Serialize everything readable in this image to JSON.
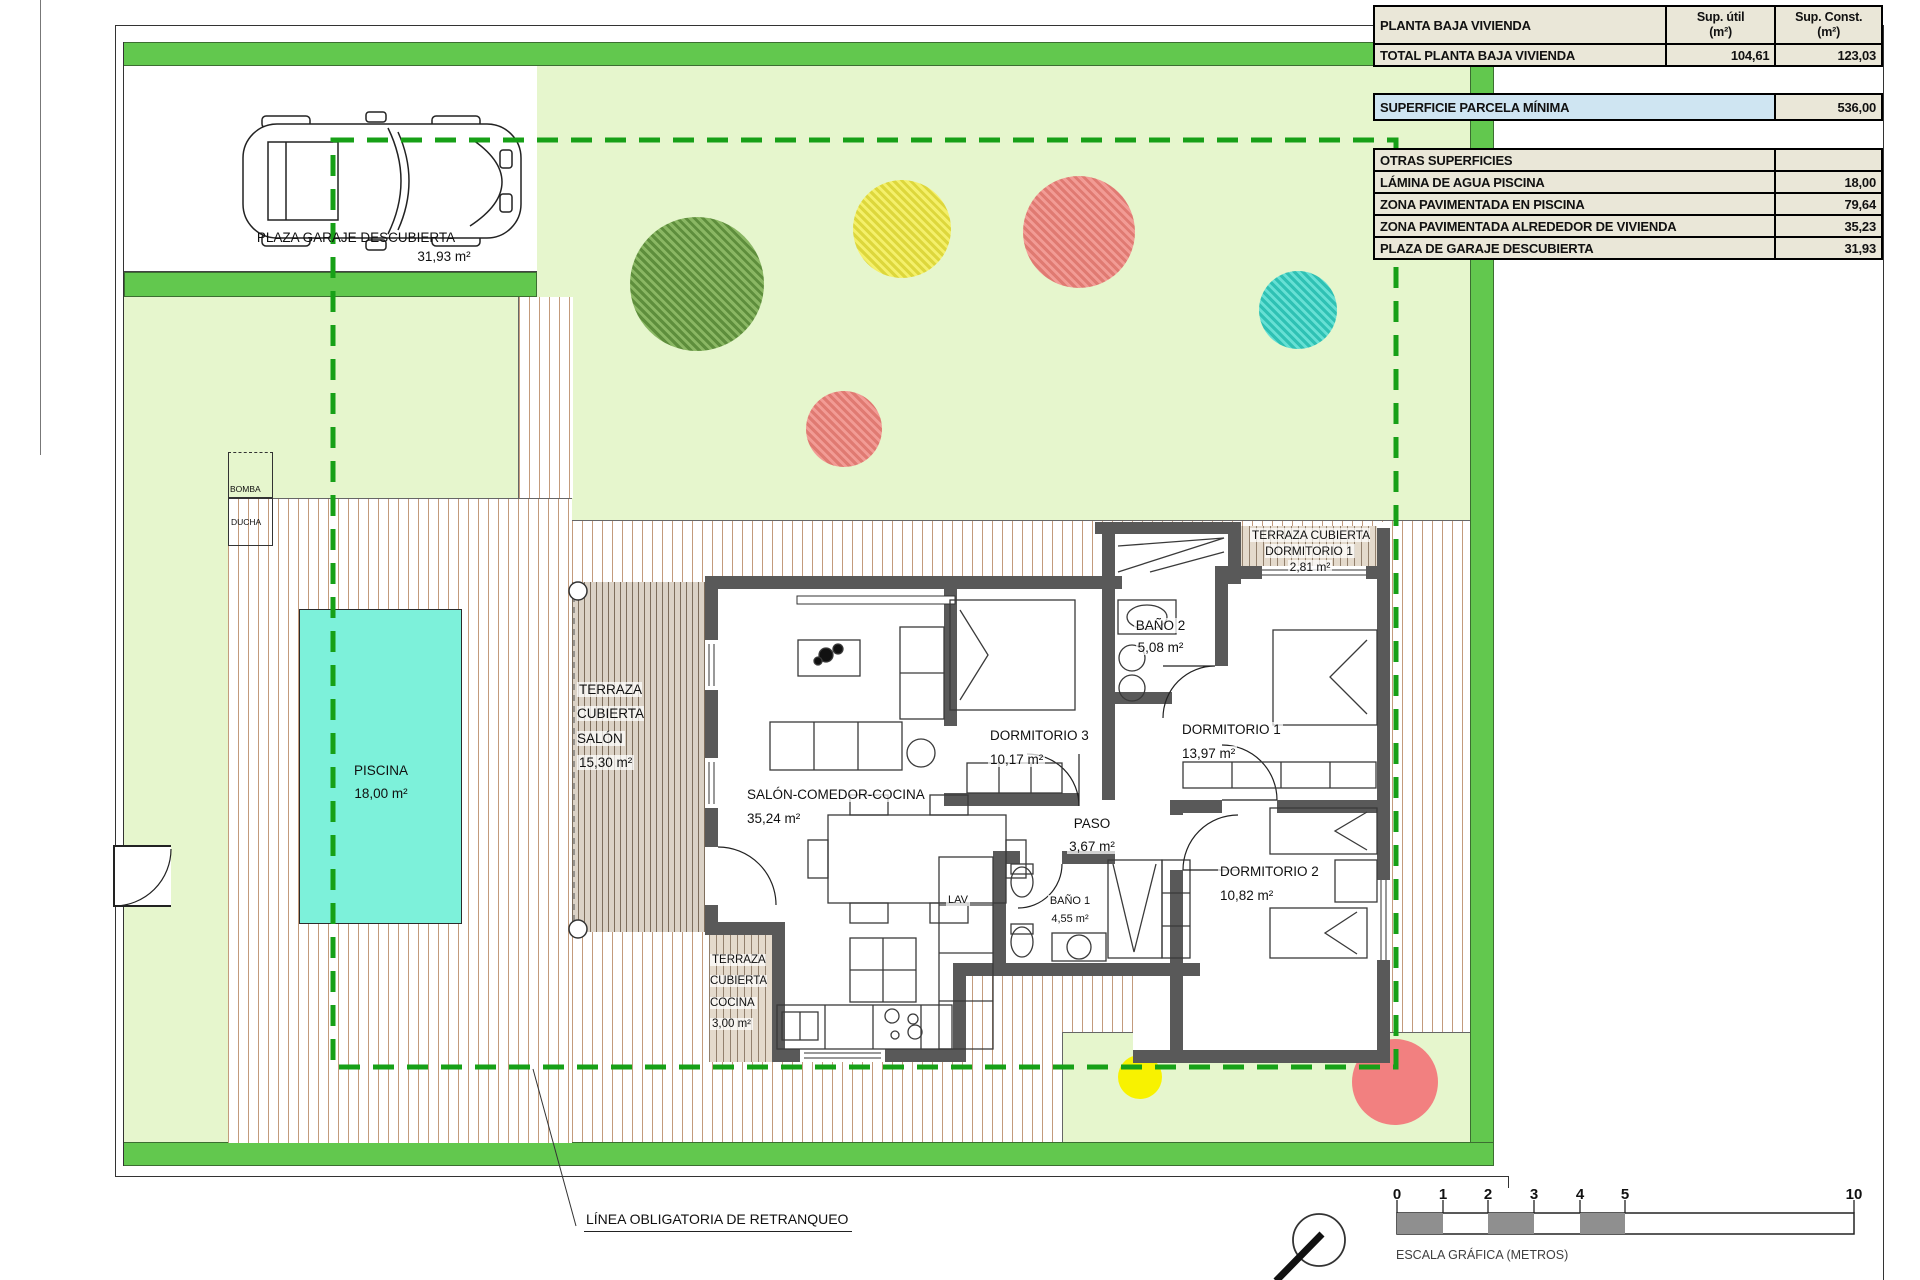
{
  "summary_table": {
    "title": "PLANTA BAJA VIVIENDA",
    "col_util": "Sup. útil",
    "col_const": "Sup. Const.",
    "unit": "(m²)",
    "total_row": {
      "label": "TOTAL PLANTA BAJA VIVIENDA",
      "util": "104,61",
      "const": "123,03"
    },
    "parcela_row": {
      "label": "SUPERFICIE PARCELA MÍNIMA",
      "value": "536,00"
    },
    "otras_title": "OTRAS SUPERFICIES",
    "otras_rows": [
      {
        "label": "LÁMINA DE AGUA PISCINA",
        "value": "18,00"
      },
      {
        "label": "ZONA PAVIMENTADA EN PISCINA",
        "value": "79,64"
      },
      {
        "label": "ZONA PAVIMENTADA ALREDEDOR DE VIVIENDA",
        "value": "35,23"
      },
      {
        "label": "PLAZA DE GARAJE DESCUBIERTA",
        "value": "31,93"
      }
    ]
  },
  "rooms": [
    {
      "name": "TERRAZA CUBIERTA SALÓN",
      "area": "15,30 m²"
    },
    {
      "name": "SALÓN-COMEDOR-COCINA",
      "area": "35,24 m²"
    },
    {
      "name": "DORMITORIO 3",
      "area": "10,17 m²"
    },
    {
      "name": "BAÑO 2",
      "area": "5,08 m²"
    },
    {
      "name": "DORMITORIO 1",
      "area": "13,97 m²"
    },
    {
      "name": "PASO",
      "area": "3,67 m²"
    },
    {
      "name": "DORMITORIO 2",
      "area": "10,82 m²"
    },
    {
      "name": "BAÑO 1",
      "area": "4,55 m²"
    },
    {
      "name": "TERRAZA CUBIERTA COCINA",
      "area": "3,00 m²"
    },
    {
      "name": "TERRAZA CUBIERTA DORMITORIO 1",
      "area": "2,81 m²"
    }
  ],
  "pool": {
    "name": "PISCINA",
    "area": "18,00 m²"
  },
  "garage": {
    "name": "PLAZA GARAJE DESCUBIERTA",
    "area": "31,93 m²"
  },
  "small_labels": {
    "bomba": "BOMBA",
    "ducha": "DUCHA",
    "lav": "LAV"
  },
  "annotations": {
    "retranqueo": "LÍNEA OBLIGATORIA DE RETRANQUEO",
    "escala": "ESCALA GRÁFICA (METROS)"
  },
  "scale": {
    "ticks": [
      "0",
      "1",
      "2",
      "3",
      "4",
      "5",
      "10"
    ]
  },
  "colors": {
    "band": "#62c84e",
    "garden": "#e6f6cd",
    "dash": "#17a017",
    "wall": "#595959",
    "pool": "#7df1da",
    "beige": "#eae7d8",
    "blue": "#cfe5f2",
    "tree_green": "#6a9a47",
    "tree_yellow": "#f2ee55",
    "tree_salmon": "#ee8f89",
    "tree_teal": "#3fd4c6",
    "dot_yellow": "#f8f200",
    "dot_red": "#f28080"
  }
}
